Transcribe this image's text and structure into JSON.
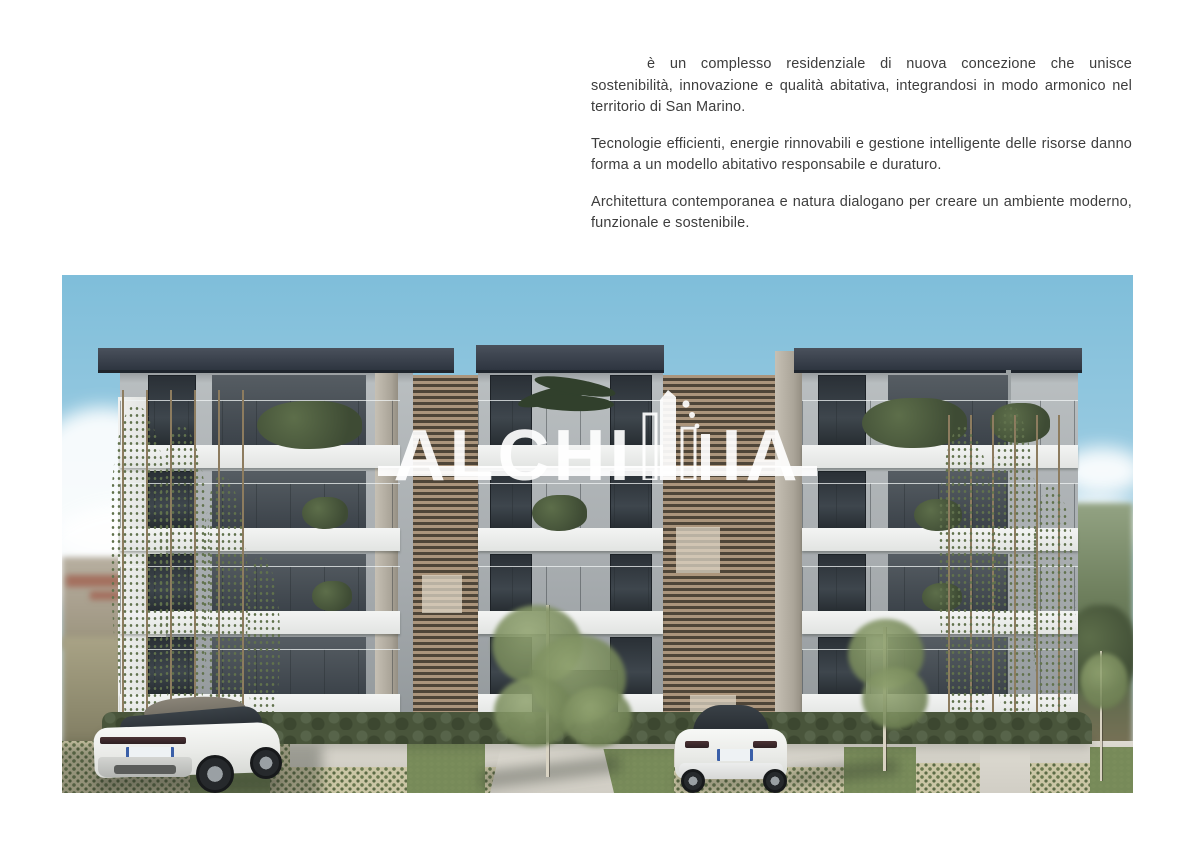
{
  "intro": {
    "paragraph1": "è un complesso residenziale di nuova concezione che unisce sostenibilità, innovazione e qualità abitativa, integrandosi in modo armonico nel territorio di San Marino.",
    "paragraph2": "Tecnologie efficienti, energie rinnovabili e gestione intelligente delle risorse danno forma a un modello abitativo responsabile e duraturo.",
    "paragraph3": "Architettura contemporanea e natura dialogano per creare un ambiente moderno, funzionale e sostenibile.",
    "text_color": "#3d3d3d"
  },
  "render": {
    "watermark": {
      "brand": "ALCHIMIA",
      "segment_before_mark": "ALCHI",
      "segment_after_mark": "IA",
      "color": "#ffffff"
    },
    "scene_colors": {
      "sky_top": "#7fbeda",
      "sky_bottom": "#dbe7ec",
      "roof_slab": "#2e3540",
      "facade": "#aab0b2",
      "fascia_band": "#eceeec",
      "louvre_wood": "#ab957c",
      "greenery": "#4e5d41",
      "grass_paver": "#6b7a50",
      "concrete_path": "#d7d4cb",
      "car_white": "#f2f3f1"
    }
  }
}
